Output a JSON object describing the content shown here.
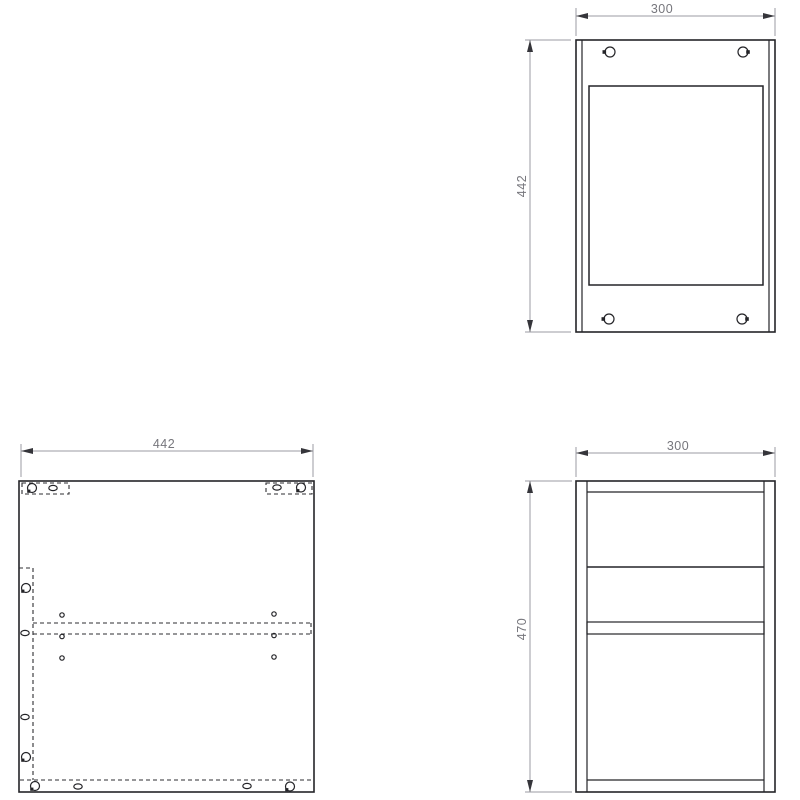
{
  "drawing": {
    "description": "cabinet-technical-drawing-three-views",
    "views": {
      "top_view": {
        "width_dim": "300",
        "height_dim": "442"
      },
      "side_panel_view": {
        "width_dim": "442"
      },
      "front_view": {
        "width_dim": "300",
        "height_dim": "470"
      }
    },
    "colors": {
      "background": "#ffffff",
      "part_outline": "#242428",
      "hidden_line": "#2e2e32",
      "dimension_line": "#9b9ba3",
      "dimension_text": "#76767c",
      "arrow": "#35353a"
    }
  }
}
